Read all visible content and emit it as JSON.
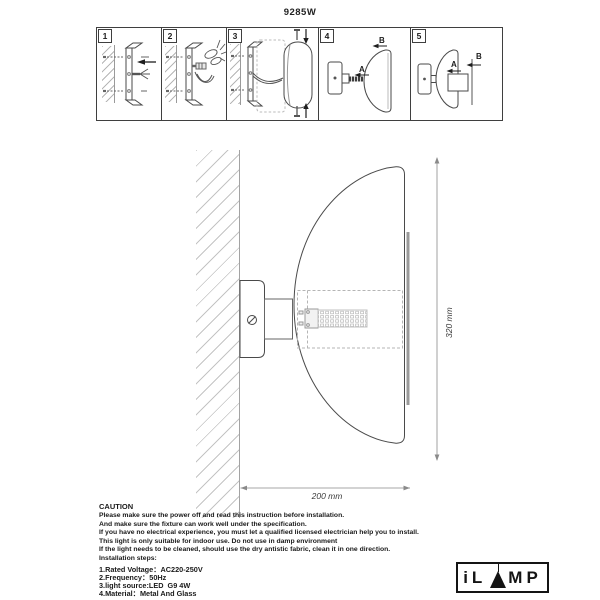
{
  "title": "9285W",
  "steps": {
    "panels": [
      {
        "number": "1"
      },
      {
        "number": "2"
      },
      {
        "number": "3"
      },
      {
        "number": "4",
        "label_a": "A",
        "label_b": "B"
      },
      {
        "number": "5",
        "label_a": "A",
        "label_b": "B"
      }
    ]
  },
  "diagram": {
    "height_dim": "320 mm",
    "width_dim": "200 mm"
  },
  "caution": {
    "heading": "CAUTION",
    "lines": [
      "Please make sure the power off and read this instruction before installation.",
      "And make sure the fixture can work well under the specification.",
      "If you have no electrical experience, you must let a qualified licensed electrician help you to install.",
      "This light is only suitable for indoor use. Do not use in damp environment",
      "If the light needs to be cleaned, should use the dry antistic fabric, clean it in one direction.",
      "Installation steps:"
    ],
    "specs": [
      "1.Rated Voltage：AC220-250V",
      "2.Frequency：50Hz",
      "3.light source:LED  G9 4W",
      "4.Material：Metal And Glass"
    ]
  },
  "logo": {
    "left": "iL",
    "right": "MP"
  },
  "colors": {
    "line": "#4a4a4a",
    "light_line": "#9a9a9a",
    "hatch": "#c8c8c8",
    "glass_bar": "#9a9a9a"
  }
}
